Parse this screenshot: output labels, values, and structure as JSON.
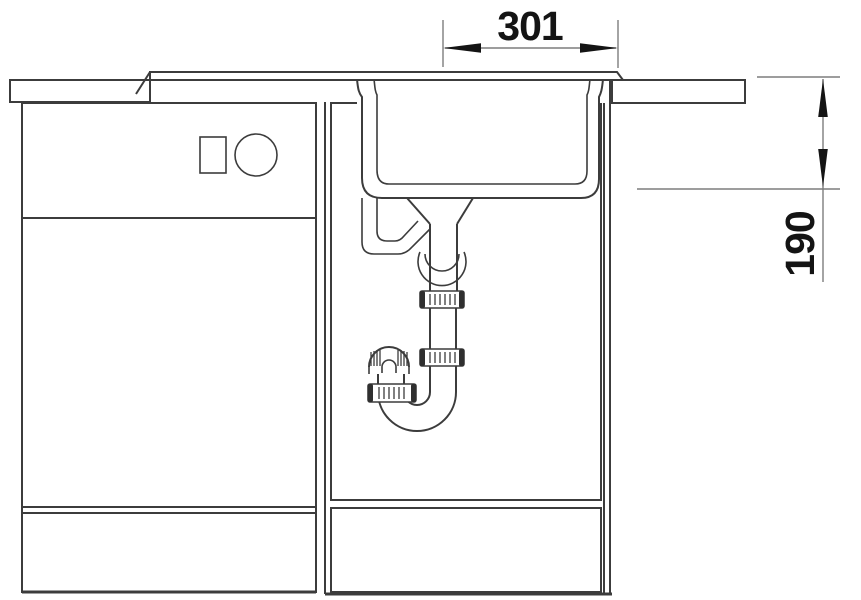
{
  "diagram": {
    "title": "sink-unit-cross-section",
    "dimensions": {
      "width": "301",
      "depth": "190"
    },
    "colors": {
      "line": "#3c3c3c",
      "dimension_line": "#7d7d7d",
      "text": "#141414",
      "background": "#ffffff"
    }
  }
}
